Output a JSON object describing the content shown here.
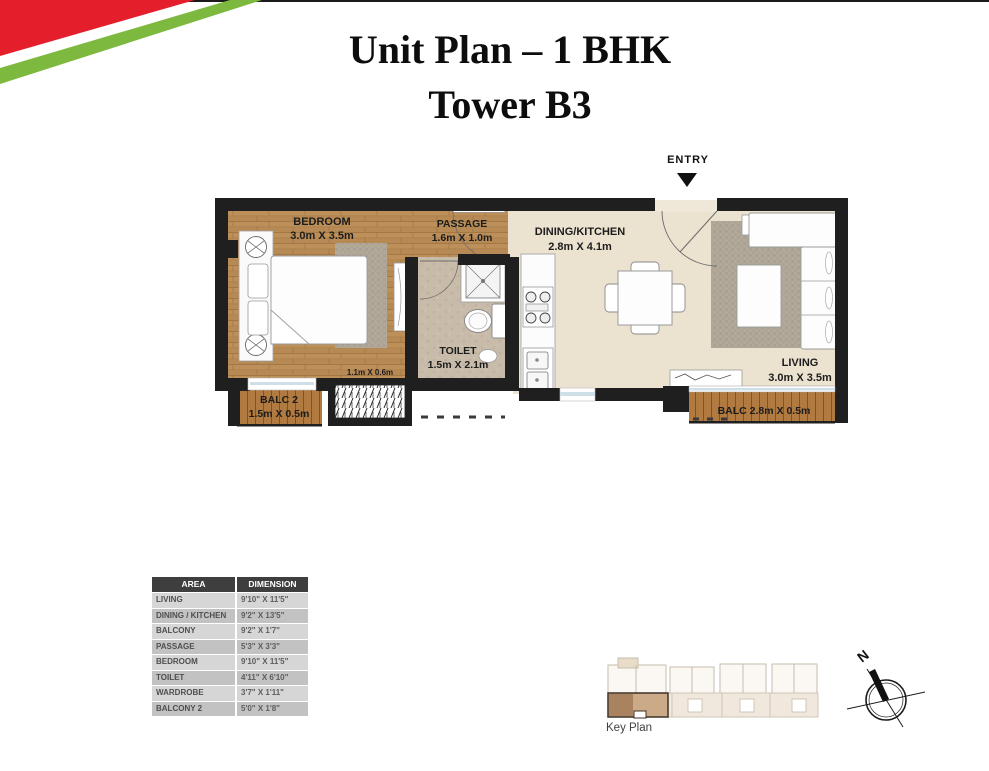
{
  "title": {
    "line1": "Unit Plan – 1 BHK",
    "line2": "Tower B3"
  },
  "entry": {
    "label": "ENTRY"
  },
  "plan": {
    "bedroom": {
      "name": "BEDROOM",
      "dim": "3.0m X 3.5m"
    },
    "passage": {
      "name": "PASSAGE",
      "dim": "1.6m X 1.0m"
    },
    "dining_kitchen": {
      "name": "DINING/KITCHEN",
      "dim": "2.8m X 4.1m"
    },
    "toilet": {
      "name": "TOILET",
      "dim": "1.5m X 2.1m"
    },
    "living": {
      "name": "LIVING",
      "dim": "3.0m X 3.5m"
    },
    "balcony2": {
      "name": "BALC 2",
      "dim": "1.5m X 0.5m"
    },
    "balcony": {
      "label": "BALC 2.8m X 0.5m"
    },
    "wardrobe": {
      "dim": "1.1m X 0.6m"
    }
  },
  "area_table": {
    "headers": [
      "AREA",
      "DIMENSION"
    ],
    "rows": [
      {
        "area": "LIVING",
        "dimension": "9'10\" X 11'5\""
      },
      {
        "area": "DINING / KITCHEN",
        "dimension": "9'2\" X 13'5\""
      },
      {
        "area": "BALCONY",
        "dimension": "9'2\" X 1'7\""
      },
      {
        "area": "PASSAGE",
        "dimension": "5'3\" X 3'3\""
      },
      {
        "area": "BEDROOM",
        "dimension": "9'10\" X 11'5\""
      },
      {
        "area": "TOILET",
        "dimension": "4'11\" X 6'10\""
      },
      {
        "area": "WARDROBE",
        "dimension": "3'7\" X 1'11\""
      },
      {
        "area": "BALCONY 2",
        "dimension": "5'0\" X 1'8\""
      }
    ]
  },
  "key_plan": {
    "label": "Key Plan"
  },
  "compass": {
    "label": "N"
  },
  "colors": {
    "accent_red": "#e51e2b",
    "accent_green": "#7cb93e",
    "wall": "#1f1f1f",
    "wood_floor": "#b78a55",
    "deck_wood": "#b07a40",
    "cream_floor": "#ece2d0",
    "toilet_floor": "#c8bba9",
    "highlight_unit": "#cbab87"
  }
}
